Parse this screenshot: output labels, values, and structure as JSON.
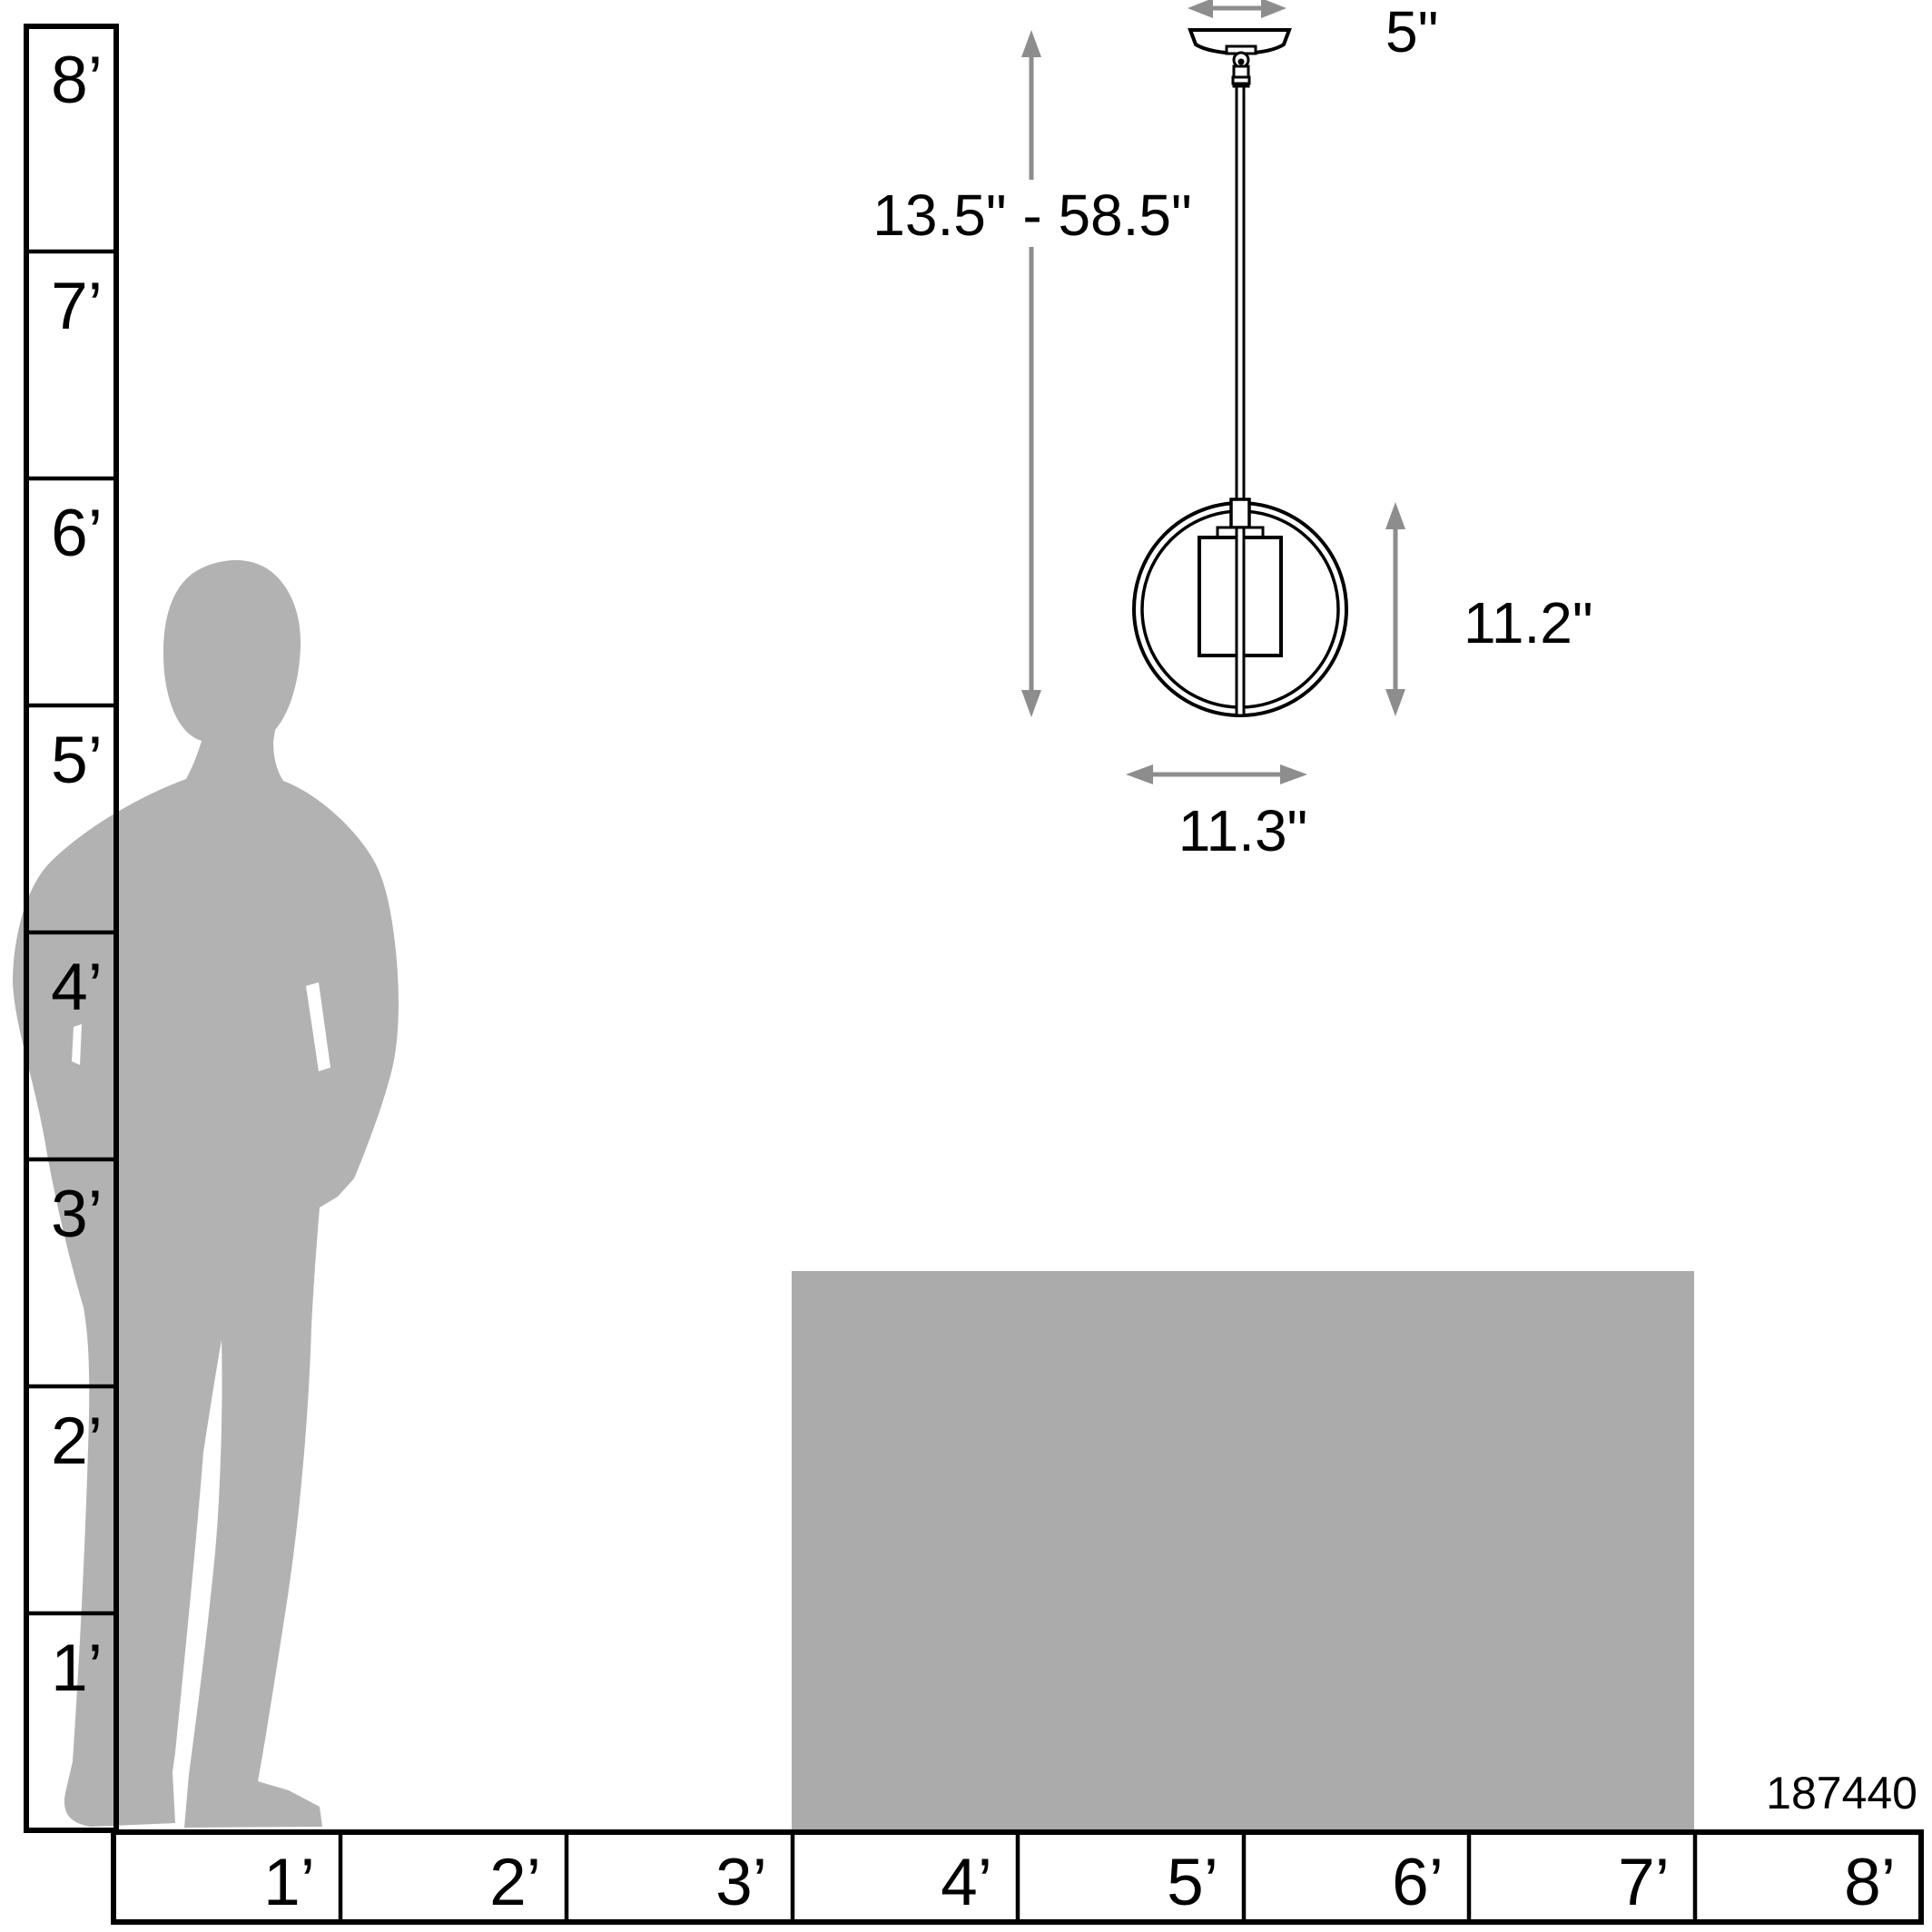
{
  "figure": {
    "product_id": "187440",
    "dimensions": {
      "canopy_width": "5\"",
      "height_range": "13.5\" - 58.5\"",
      "fixture_height": "11.2\"",
      "fixture_width": "11.3\""
    }
  },
  "rulers": {
    "vertical_feet": [
      "8’",
      "7’",
      "6’",
      "5’",
      "4’",
      "3’",
      "2’",
      "1’"
    ],
    "horizontal_feet": [
      "1’",
      "2’",
      "3’",
      "4’",
      "5’",
      "6’",
      "7’",
      "8’"
    ]
  },
  "colors": {
    "line_black": "#000000",
    "arrow_gray": "#8d8d8d",
    "silhouette_gray": "#b2b2b2",
    "table_gray": "#ababab",
    "background": "#ffffff"
  }
}
